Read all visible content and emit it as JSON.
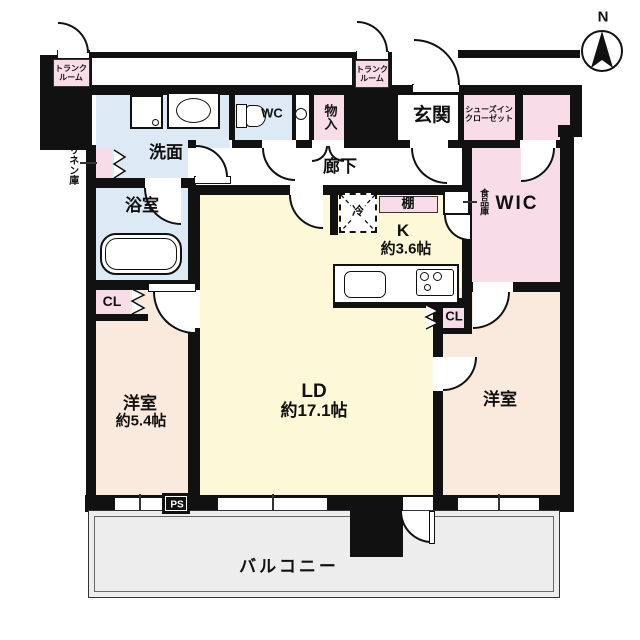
{
  "plan_type": "apartment-floor-plan",
  "compass": {
    "north": "N"
  },
  "colors": {
    "wall": "#111111",
    "wet_area_blue": "#dde9f4",
    "storage_pink": "#f8dde9",
    "living_yellow": "#fcf8d8",
    "bedroom_peach": "#faeade",
    "balcony_gray": "#ededed"
  },
  "labels": {
    "trunk1_l1": "トランク",
    "trunk1_l2": "ルーム",
    "trunk2_l1": "トランク",
    "trunk2_l2": "ルーム",
    "linen": "リネン庫",
    "washroom": "洗面",
    "wc": "WC",
    "storage": "物入",
    "entrance": "玄関",
    "sic_l1": "シューズイン",
    "sic_l2": "クローゼット",
    "hallway": "廊下",
    "bathroom": "浴室",
    "fridge": "冷",
    "shelf": "棚",
    "pantry": "食品庫",
    "wic": "WIC",
    "kitchen_name": "K",
    "kitchen_size": "約3.6帖",
    "closet1": "CL",
    "closet2": "CL",
    "bedroom_left_name": "洋室",
    "bedroom_left_size": "約5.4帖",
    "living_name": "LD",
    "living_size": "約17.1帖",
    "bedroom_right_name": "洋室",
    "pipe_space": "PS",
    "balcony": "バルコニー"
  }
}
